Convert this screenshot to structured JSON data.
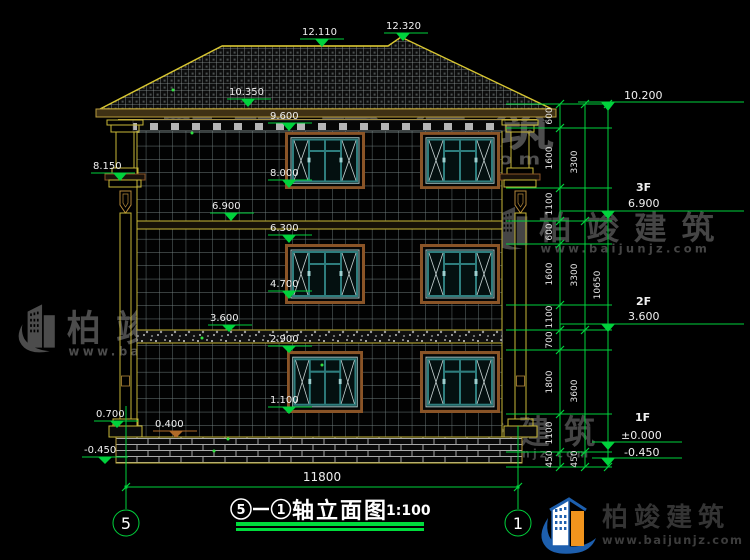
{
  "drawing": {
    "brand": {
      "name": "柏竣建筑",
      "url": "www.baijunjz.com"
    },
    "title": {
      "axis_start": "5",
      "axis_end": "1",
      "name": "轴立面图",
      "scale": "1:100"
    },
    "axis_bubbles": {
      "left": "5",
      "right": "1"
    },
    "levels_left": [
      "12.110",
      "12.320",
      "10.350",
      "9.600",
      "8.150",
      "8.000",
      "6.900",
      "6.300",
      "4.700",
      "3.600",
      "2.900",
      "1.100",
      "0.700",
      "0.400",
      "-0.450"
    ],
    "levels_right": [
      {
        "floor": "",
        "value": "10.200"
      },
      {
        "floor": "3F",
        "value": "6.900"
      },
      {
        "floor": "2F",
        "value": "3.600"
      },
      {
        "floor": "1F",
        "value": "±0.000"
      },
      {
        "floor": "",
        "value": "-0.450"
      }
    ],
    "dims": {
      "bottom_total": "11800",
      "right_total": "10650",
      "right_mid": [
        "3300",
        "3300",
        "3600",
        "450"
      ],
      "right_inner": [
        "600",
        "1600",
        "1100",
        "600",
        "1600",
        "1100",
        "700",
        "1800",
        "1100",
        "450"
      ]
    }
  }
}
